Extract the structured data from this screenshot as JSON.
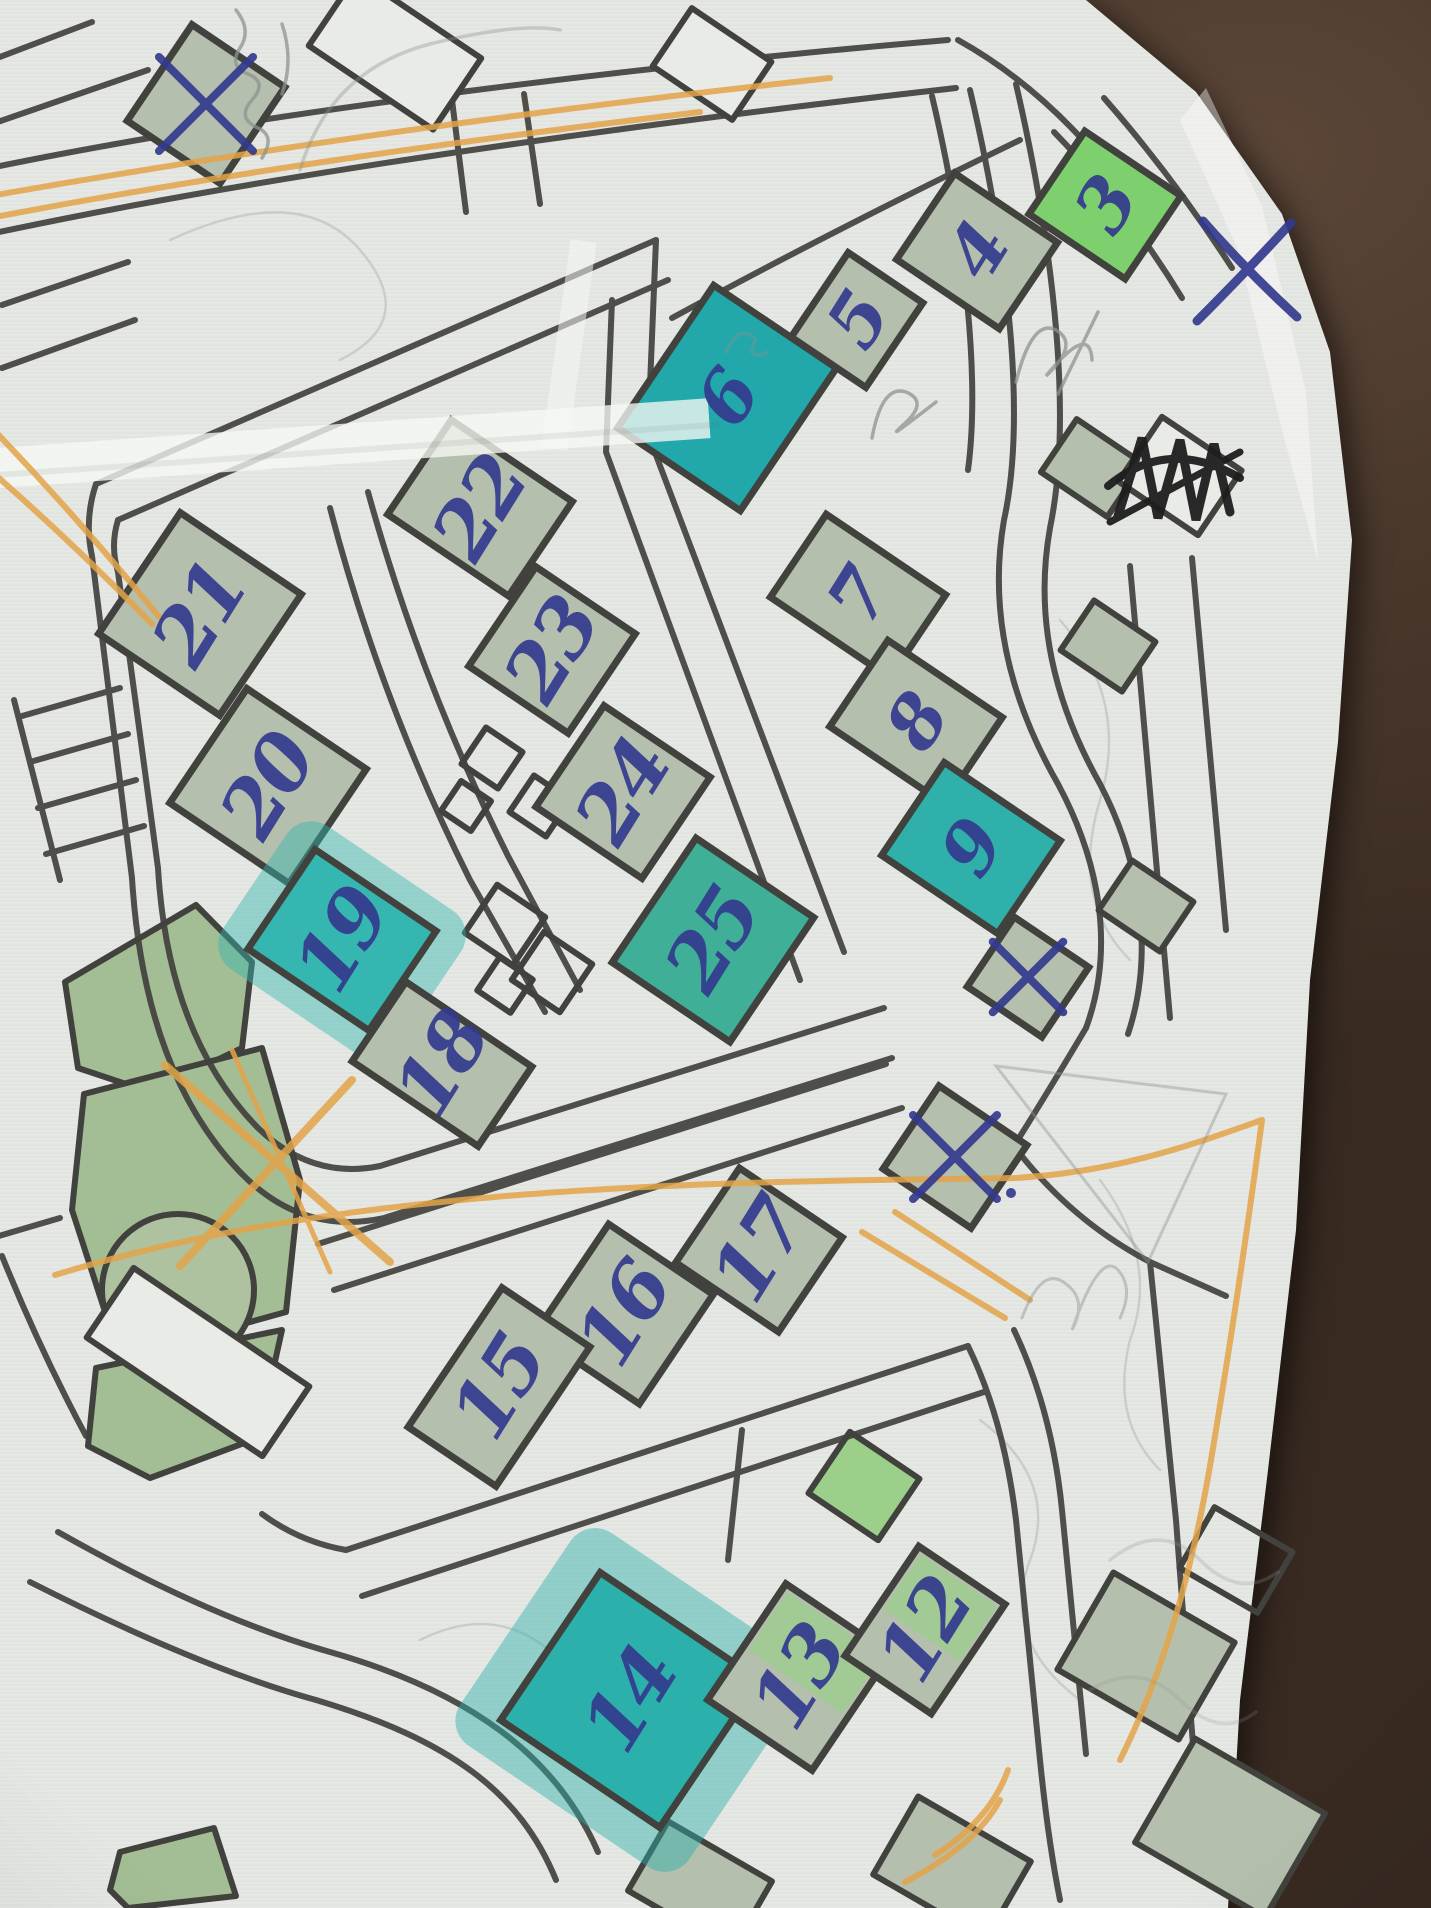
{
  "photo": {
    "width": 1431,
    "height": 1908,
    "description": "Photo of a printed street/orienteering map sheet lying on a dark brown table, annotated by hand with numbered control buildings in blue ballpoint pen, teal and green highlighter fills, orange route lines, pencil scribbles and crossed-out blocks"
  },
  "palette": {
    "table": "#46362c",
    "paper": "#e9ebe7",
    "print_line": "#41413d",
    "building_fill": "#b5bfae",
    "park_fill": "#a3bd94",
    "teal_highlight": "#2fada6",
    "bright_green_highlight": "#7ed06f",
    "light_green_highlight": "#92d37f",
    "pen_blue": "#333a8e",
    "orange_highlight": "#e3a449",
    "pencil_gray": "#8e938c",
    "marker_black": "#1e1e1e"
  },
  "controls": [
    {
      "label": "3",
      "x": 1105,
      "y": 205,
      "w": 116,
      "h": 100,
      "fill": "bright"
    },
    {
      "label": "4",
      "x": 977,
      "y": 251,
      "w": 124,
      "h": 104,
      "fill": "plain"
    },
    {
      "label": "5",
      "x": 857,
      "y": 320,
      "w": 90,
      "h": 102,
      "fill": "plain"
    },
    {
      "label": "6",
      "x": 727,
      "y": 398,
      "w": 148,
      "h": 172,
      "fill": "teal",
      "hex": "#22a7ab"
    },
    {
      "label": "7",
      "x": 858,
      "y": 596,
      "w": 144,
      "h": 100,
      "fill": "plain"
    },
    {
      "label": "8",
      "x": 916,
      "y": 722,
      "w": 138,
      "h": 104,
      "fill": "plain"
    },
    {
      "label": "9",
      "x": 971,
      "y": 848,
      "w": 140,
      "h": 112,
      "fill": "teal",
      "hex": "#2fb0aa"
    },
    {
      "label": "22",
      "x": 480,
      "y": 508,
      "w": 146,
      "h": 114,
      "fill": "plain"
    },
    {
      "label": "21",
      "x": 200,
      "y": 614,
      "w": 146,
      "h": 146,
      "fill": "plain"
    },
    {
      "label": "23",
      "x": 552,
      "y": 650,
      "w": 120,
      "h": 120,
      "fill": "plain"
    },
    {
      "label": "20",
      "x": 268,
      "y": 786,
      "w": 144,
      "h": 138,
      "fill": "plain"
    },
    {
      "label": "24",
      "x": 623,
      "y": 792,
      "w": 128,
      "h": 122,
      "fill": "plain"
    },
    {
      "label": "19",
      "x": 342,
      "y": 940,
      "w": 146,
      "h": 120,
      "fill": "teal",
      "hex": "#36b6b0",
      "halo": true
    },
    {
      "label": "25",
      "x": 713,
      "y": 940,
      "w": 142,
      "h": 150,
      "fill": "teal",
      "hex": "#3fb097"
    },
    {
      "label": "18",
      "x": 442,
      "y": 1064,
      "w": 152,
      "h": 96,
      "fill": "plain"
    },
    {
      "label": "17",
      "x": 759,
      "y": 1250,
      "w": 124,
      "h": 114,
      "fill": "plain"
    },
    {
      "label": "16",
      "x": 624,
      "y": 1314,
      "w": 126,
      "h": 132,
      "fill": "plain"
    },
    {
      "label": "15",
      "x": 499,
      "y": 1387,
      "w": 106,
      "h": 168,
      "fill": "plain"
    },
    {
      "label": "14",
      "x": 630,
      "y": 1700,
      "w": 192,
      "h": 178,
      "fill": "teal",
      "hex": "#2cb0ab",
      "halo": true
    },
    {
      "label": "13",
      "x": 799,
      "y": 1677,
      "w": 126,
      "h": 140,
      "fill": "light"
    },
    {
      "label": "12",
      "x": 925,
      "y": 1630,
      "w": 104,
      "h": 132,
      "fill": "light"
    }
  ],
  "crossed_blocks": [
    {
      "x": 206,
      "y": 104,
      "w": 112,
      "h": 116
    },
    {
      "x": 1028,
      "y": 977,
      "w": 90,
      "h": 84
    },
    {
      "x": 955,
      "y": 1157,
      "w": 106,
      "h": 100,
      "dot": true
    }
  ],
  "road_x_mark": {
    "x": 1247,
    "y": 271,
    "size": 100
  },
  "visible_control_numbers": [
    "3",
    "4",
    "5",
    "6",
    "7",
    "8",
    "9",
    "12",
    "13",
    "14",
    "15",
    "16",
    "17",
    "18",
    "19",
    "20",
    "21",
    "22",
    "23",
    "24",
    "25"
  ]
}
